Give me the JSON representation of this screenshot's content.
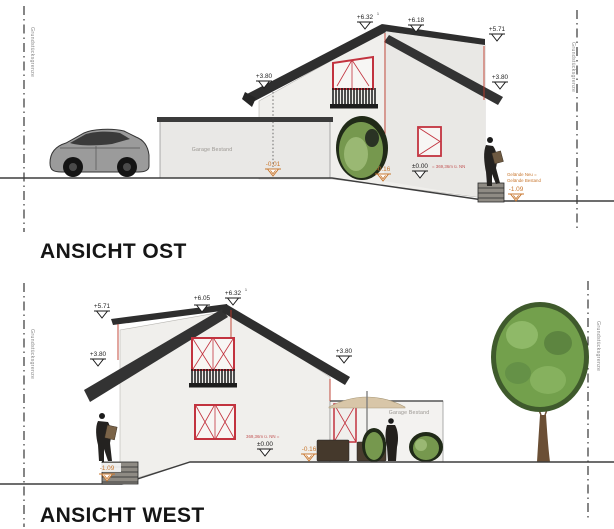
{
  "labels": {
    "boundary": "Grundstücksgrenze",
    "garage": "Garage Bestand"
  },
  "colors": {
    "wall": "#f0efec",
    "wall_shade": "#e9e8e5",
    "roof": "#2e2e2e",
    "window_frame_red": "#c2333f",
    "dimension_red": "#c0392b",
    "level_orange": "#c8772f",
    "note_red": "#c25555",
    "green": "#76984e",
    "tree_green": "#73a04c",
    "gray_text": "#9a9691",
    "ground_line": "#3d3d3d"
  },
  "ost": {
    "title": "ANSICHT OST",
    "levels": {
      "ridge": "+6.32",
      "ridge_sup": "1",
      "ridge_back": "+6.18",
      "right_top": "+5.71",
      "eave_left": "+3.80",
      "eave_right": "+3.80",
      "zero": "±0.00",
      "zero_suffix": "= 369,36m ü. NN",
      "garage_ground": "-0.01",
      "terrace": "-0.16",
      "lower_ground": "-1.09"
    },
    "notes": {
      "line1": "Gelände Neu =",
      "line2": "Gelände Bestand"
    }
  },
  "west": {
    "title": "ANSICHT WEST",
    "levels": {
      "ridge": "+6.32",
      "ridge_sup": "1",
      "ridge_front": "+6.05",
      "left_top": "+5.71",
      "eave_left": "+3.80",
      "eave_right": "+3.80",
      "zero": "±0.00",
      "zero_prefix": "369,36m ü. NN =",
      "terrace": "-0.16",
      "lower_ground": "-1.09"
    }
  }
}
